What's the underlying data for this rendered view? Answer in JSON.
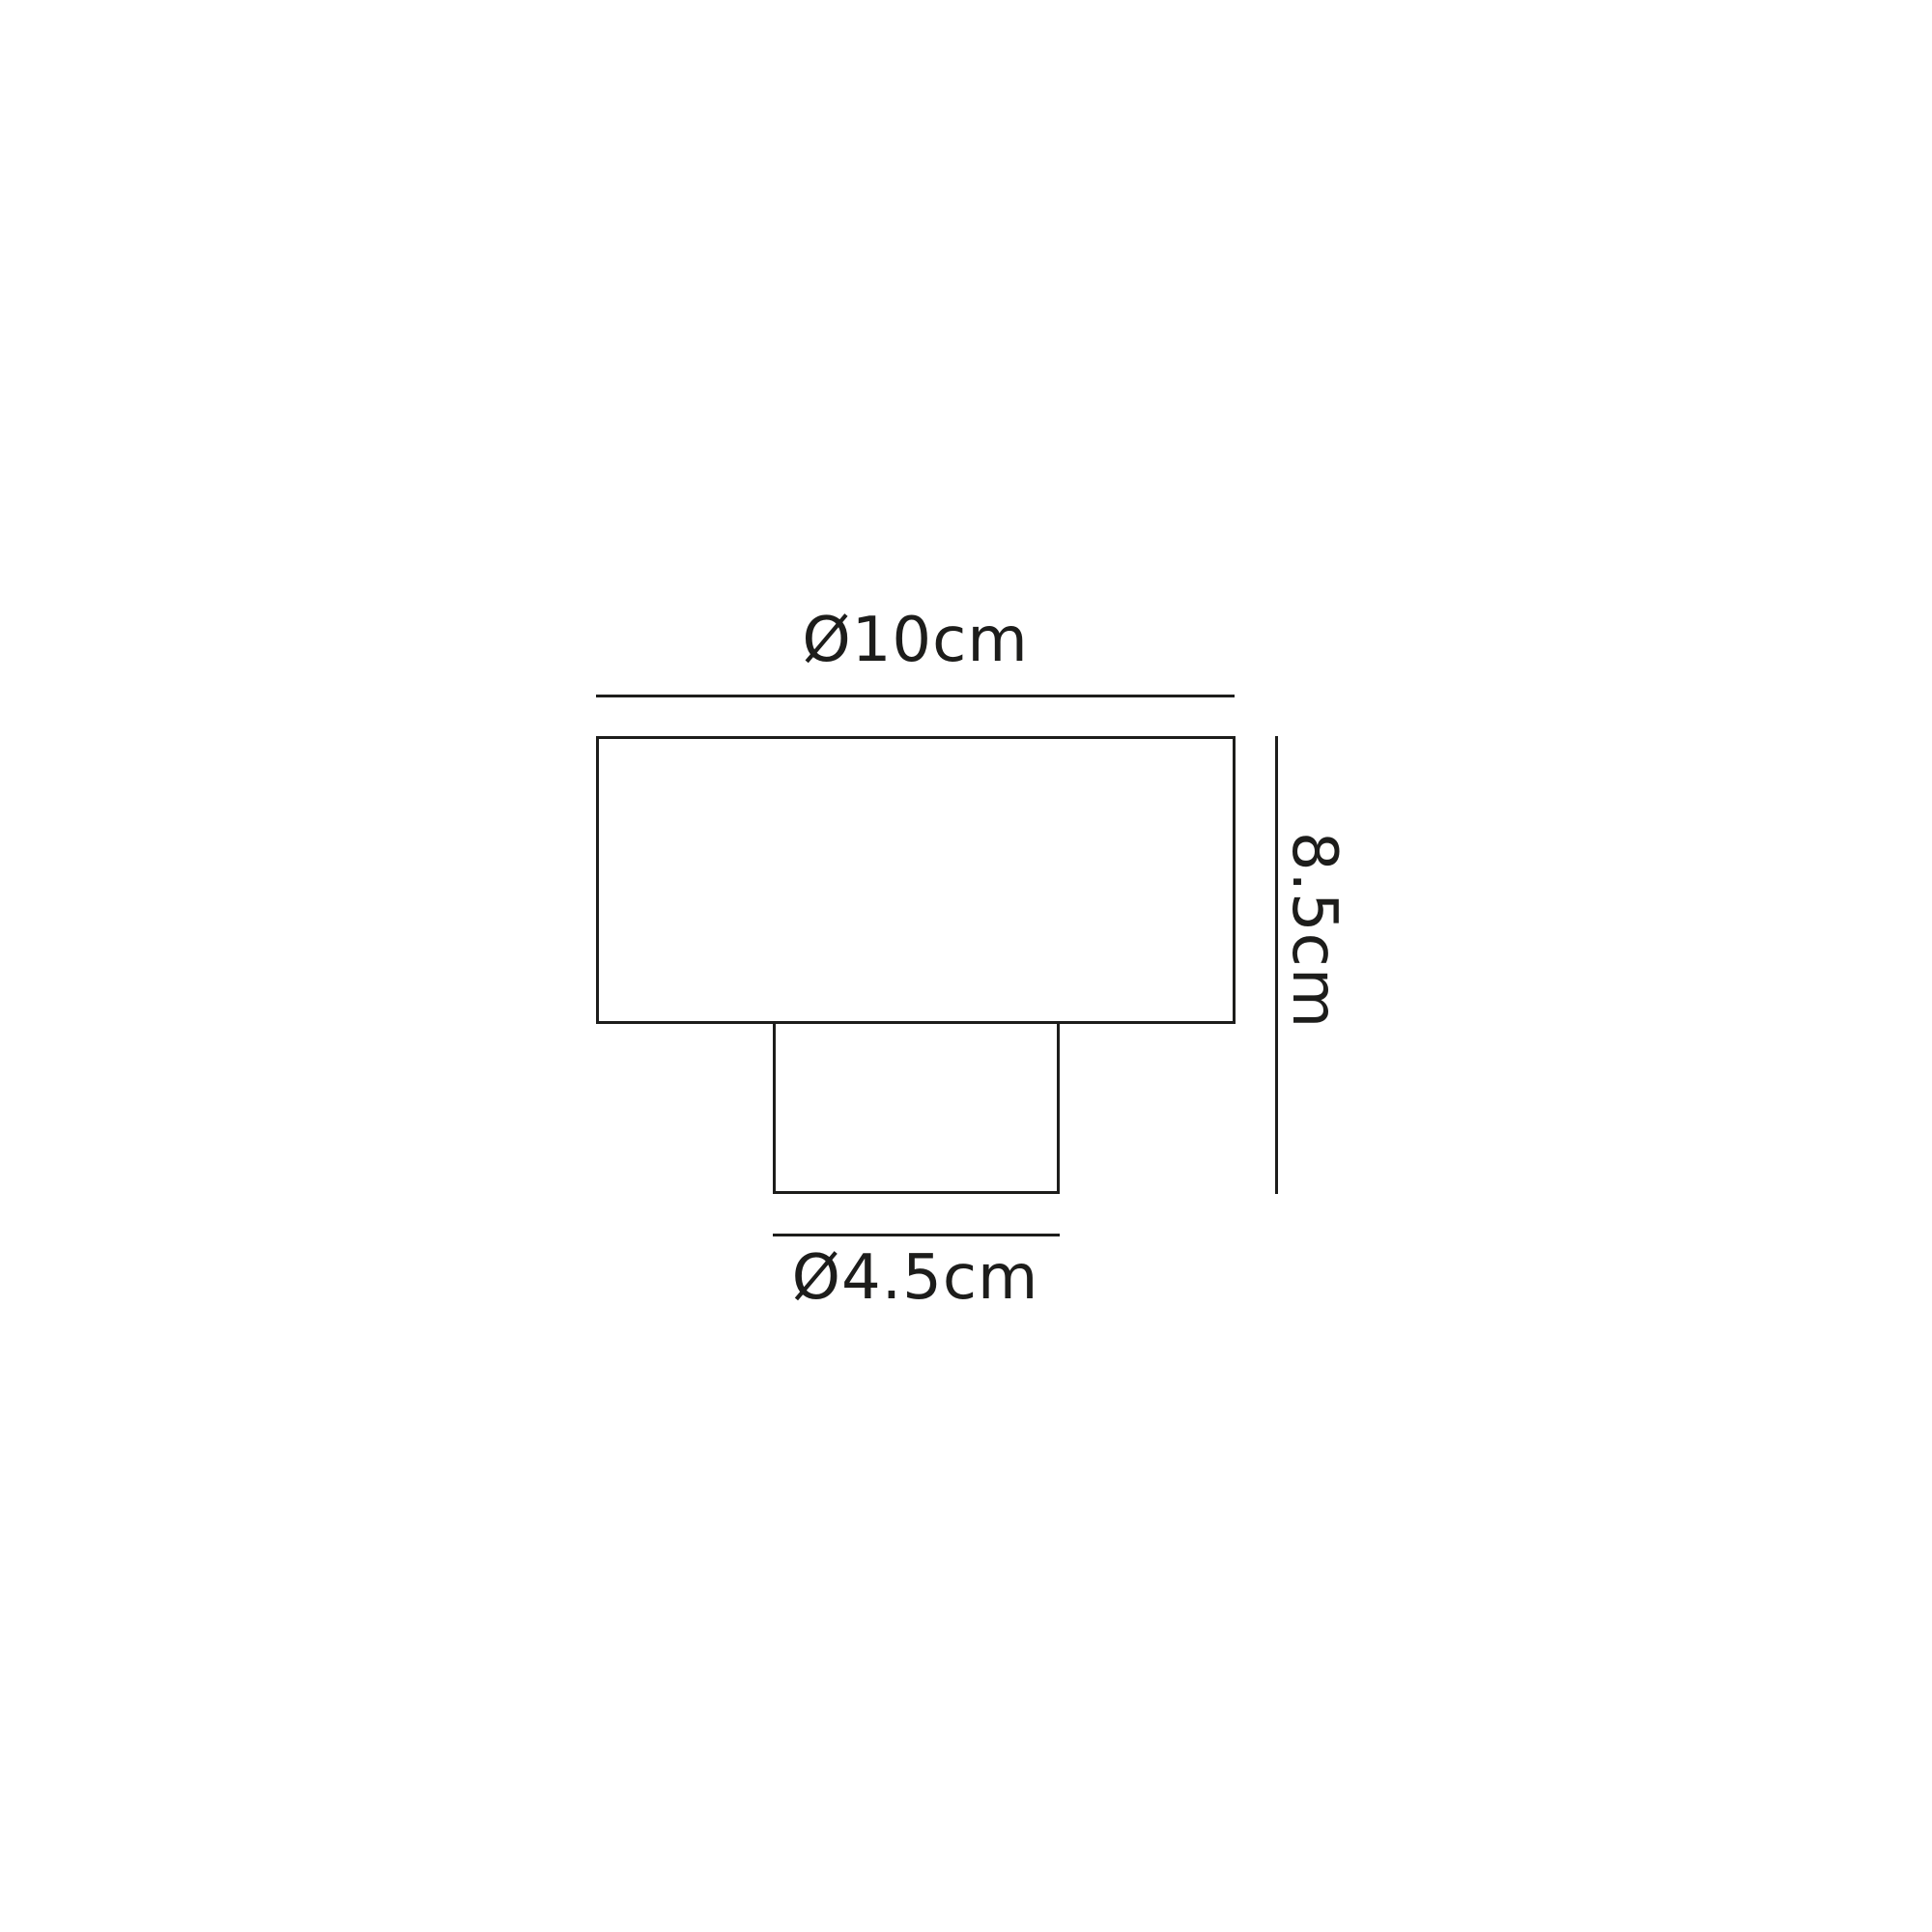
{
  "diagram": {
    "type": "technical-dimension-drawing",
    "subject": "two-tier lamp / light fitting front elevation",
    "background_color": "#ffffff",
    "stroke_color": "#1d1d1b",
    "dimensions": {
      "top_diameter": {
        "label": "Ø10cm",
        "applies_to": "shade width",
        "orientation": "horizontal"
      },
      "overall_height": {
        "label": "8.5cm",
        "applies_to": "total height",
        "orientation": "vertical-rotated-90"
      },
      "base_diameter": {
        "label": "Ø4.5cm",
        "applies_to": "base width",
        "orientation": "horizontal"
      }
    }
  }
}
